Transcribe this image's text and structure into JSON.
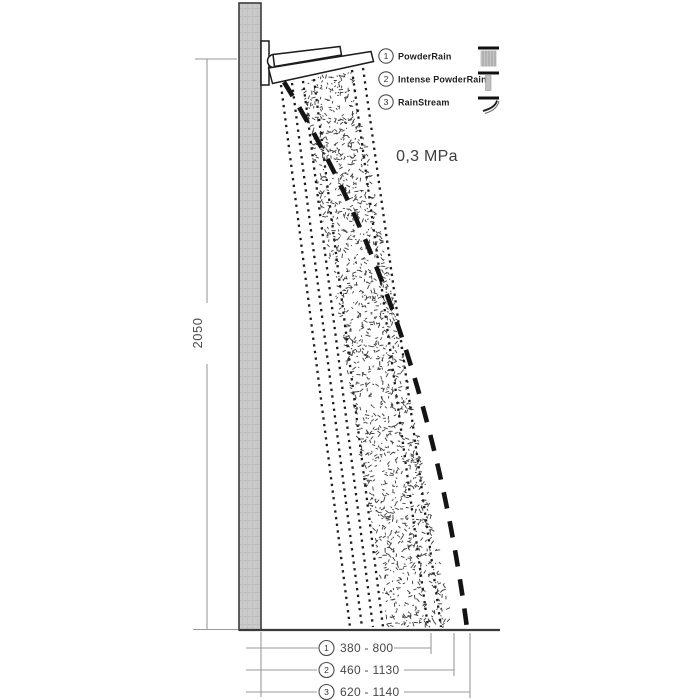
{
  "legend": {
    "items": [
      {
        "number": "1",
        "label": "PowderRain",
        "icon": "wide-spray-icon"
      },
      {
        "number": "2",
        "label": "Intense PowderRain",
        "icon": "narrow-spray-icon"
      },
      {
        "number": "3",
        "label": "RainStream",
        "icon": "stream-curve-icon"
      }
    ]
  },
  "pressure": {
    "value": "0,3 MPa"
  },
  "dimensions": {
    "wall_height": "2050",
    "floor_ranges": [
      {
        "number": "1",
        "range": "380 - 800"
      },
      {
        "number": "2",
        "range": "460 - 1130"
      },
      {
        "number": "3",
        "range": "620 - 1140"
      }
    ]
  },
  "colors": {
    "wall_fill": "#cbcbcb",
    "ink": "#1c1c1c",
    "dim_gray": "#9a9a9a",
    "text_gray": "#474747",
    "icon_gray": "#c4c4c4"
  }
}
